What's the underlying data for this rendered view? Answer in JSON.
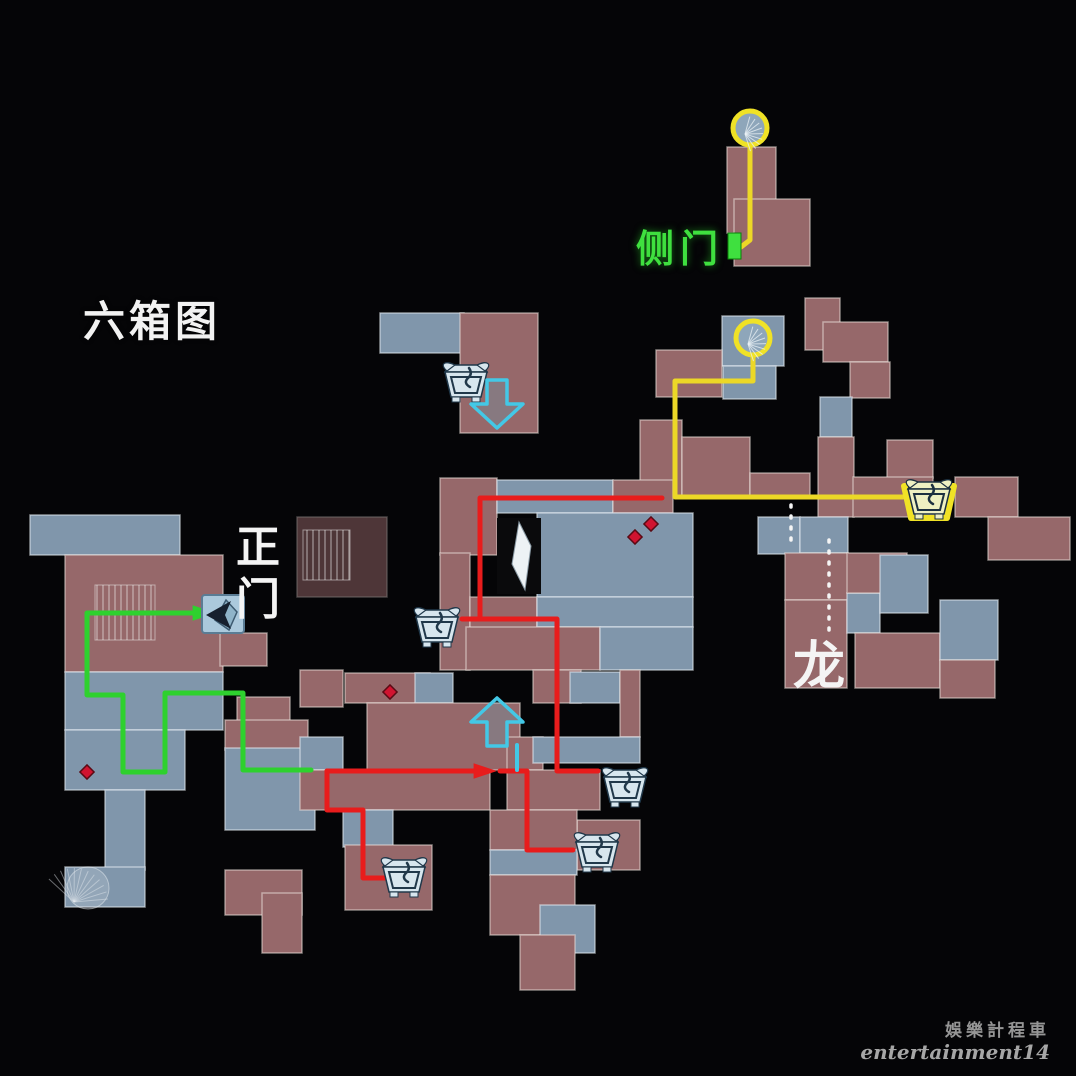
{
  "labels": {
    "title": "六箱图",
    "side_door": "侧门",
    "main_door": "正门",
    "dragon": "龙"
  },
  "watermark": {
    "line1": "娛樂計程車",
    "line2": "entertainment14"
  },
  "colors": {
    "bg": "#050507",
    "red_room": "#96686a",
    "blue_room": "#8096ab",
    "red": "#e81c1c",
    "green": "#2ed12e",
    "yellow": "#ecd827",
    "cyan": "#43c8e6",
    "white": "#f5f5f5",
    "highlight": "#f0e226",
    "label_green": "#3fe03f",
    "diamond": "#d01430"
  },
  "map": {
    "rooms": [
      {
        "x": 727,
        "y": 147,
        "w": 49,
        "h": 86,
        "c": "r"
      },
      {
        "x": 734,
        "y": 199,
        "w": 76,
        "h": 67,
        "c": "r"
      },
      {
        "x": 380,
        "y": 313,
        "w": 84,
        "h": 40,
        "c": "b"
      },
      {
        "x": 460,
        "y": 313,
        "w": 78,
        "h": 120,
        "c": "r"
      },
      {
        "x": 722,
        "y": 316,
        "w": 62,
        "h": 50,
        "c": "b"
      },
      {
        "x": 656,
        "y": 350,
        "w": 66,
        "h": 47,
        "c": "r"
      },
      {
        "x": 723,
        "y": 366,
        "w": 53,
        "h": 33,
        "c": "b"
      },
      {
        "x": 805,
        "y": 298,
        "w": 35,
        "h": 52,
        "c": "r"
      },
      {
        "x": 823,
        "y": 322,
        "w": 65,
        "h": 40,
        "c": "r"
      },
      {
        "x": 850,
        "y": 362,
        "w": 40,
        "h": 36,
        "c": "r"
      },
      {
        "x": 820,
        "y": 397,
        "w": 32,
        "h": 40,
        "c": "b"
      },
      {
        "x": 818,
        "y": 437,
        "w": 36,
        "h": 80,
        "c": "r"
      },
      {
        "x": 887,
        "y": 440,
        "w": 46,
        "h": 38,
        "c": "r"
      },
      {
        "x": 853,
        "y": 477,
        "w": 80,
        "h": 40,
        "c": "r"
      },
      {
        "x": 955,
        "y": 477,
        "w": 63,
        "h": 40,
        "c": "r"
      },
      {
        "x": 988,
        "y": 517,
        "w": 82,
        "h": 43,
        "c": "r"
      },
      {
        "x": 640,
        "y": 420,
        "w": 42,
        "h": 77,
        "c": "r"
      },
      {
        "x": 682,
        "y": 437,
        "w": 68,
        "h": 60,
        "c": "r"
      },
      {
        "x": 750,
        "y": 473,
        "w": 60,
        "h": 24,
        "c": "r"
      },
      {
        "x": 758,
        "y": 517,
        "w": 42,
        "h": 37,
        "c": "b"
      },
      {
        "x": 800,
        "y": 517,
        "w": 48,
        "h": 36,
        "c": "b"
      },
      {
        "x": 785,
        "y": 553,
        "w": 63,
        "h": 47,
        "c": "r"
      },
      {
        "x": 785,
        "y": 600,
        "w": 62,
        "h": 88,
        "c": "r"
      },
      {
        "x": 847,
        "y": 593,
        "w": 33,
        "h": 40,
        "c": "b"
      },
      {
        "x": 847,
        "y": 553,
        "w": 60,
        "h": 40,
        "c": "r"
      },
      {
        "x": 880,
        "y": 555,
        "w": 48,
        "h": 58,
        "c": "b"
      },
      {
        "x": 855,
        "y": 633,
        "w": 85,
        "h": 55,
        "c": "r"
      },
      {
        "x": 940,
        "y": 600,
        "w": 58,
        "h": 60,
        "c": "b"
      },
      {
        "x": 940,
        "y": 660,
        "w": 55,
        "h": 38,
        "c": "r"
      },
      {
        "x": 440,
        "y": 478,
        "w": 57,
        "h": 77,
        "c": "r"
      },
      {
        "x": 497,
        "y": 480,
        "w": 116,
        "h": 33,
        "c": "b"
      },
      {
        "x": 613,
        "y": 480,
        "w": 60,
        "h": 33,
        "c": "r"
      },
      {
        "x": 537,
        "y": 513,
        "w": 156,
        "h": 84,
        "c": "b"
      },
      {
        "x": 440,
        "y": 553,
        "w": 30,
        "h": 117,
        "c": "r"
      },
      {
        "x": 470,
        "y": 597,
        "w": 67,
        "h": 45,
        "c": "r"
      },
      {
        "x": 537,
        "y": 597,
        "w": 156,
        "h": 30,
        "c": "b"
      },
      {
        "x": 466,
        "y": 627,
        "w": 134,
        "h": 43,
        "c": "r"
      },
      {
        "x": 600,
        "y": 627,
        "w": 93,
        "h": 43,
        "c": "b"
      },
      {
        "x": 297,
        "y": 517,
        "w": 90,
        "h": 80,
        "c": "r",
        "d": 1
      },
      {
        "x": 30,
        "y": 515,
        "w": 150,
        "h": 40,
        "c": "b"
      },
      {
        "x": 65,
        "y": 555,
        "w": 158,
        "h": 117,
        "c": "r"
      },
      {
        "x": 220,
        "y": 633,
        "w": 47,
        "h": 33,
        "c": "r"
      },
      {
        "x": 65,
        "y": 672,
        "w": 158,
        "h": 58,
        "c": "b"
      },
      {
        "x": 237,
        "y": 697,
        "w": 53,
        "h": 33,
        "c": "r"
      },
      {
        "x": 225,
        "y": 720,
        "w": 83,
        "h": 30,
        "c": "r"
      },
      {
        "x": 225,
        "y": 748,
        "w": 90,
        "h": 82,
        "c": "b"
      },
      {
        "x": 65,
        "y": 730,
        "w": 120,
        "h": 60,
        "c": "b"
      },
      {
        "x": 105,
        "y": 790,
        "w": 40,
        "h": 80,
        "c": "b"
      },
      {
        "x": 65,
        "y": 867,
        "w": 80,
        "h": 40,
        "c": "b"
      },
      {
        "x": 225,
        "y": 870,
        "w": 77,
        "h": 45,
        "c": "r"
      },
      {
        "x": 262,
        "y": 893,
        "w": 40,
        "h": 60,
        "c": "r"
      },
      {
        "x": 300,
        "y": 670,
        "w": 43,
        "h": 37,
        "c": "r"
      },
      {
        "x": 345,
        "y": 673,
        "w": 85,
        "h": 30,
        "c": "r"
      },
      {
        "x": 415,
        "y": 673,
        "w": 38,
        "h": 30,
        "c": "b"
      },
      {
        "x": 367,
        "y": 703,
        "w": 153,
        "h": 67,
        "c": "r"
      },
      {
        "x": 533,
        "y": 670,
        "w": 48,
        "h": 33,
        "c": "r"
      },
      {
        "x": 570,
        "y": 672,
        "w": 50,
        "h": 31,
        "c": "b"
      },
      {
        "x": 620,
        "y": 670,
        "w": 20,
        "h": 67,
        "c": "r"
      },
      {
        "x": 507,
        "y": 737,
        "w": 36,
        "h": 33,
        "c": "r"
      },
      {
        "x": 533,
        "y": 737,
        "w": 107,
        "h": 26,
        "c": "b"
      },
      {
        "x": 300,
        "y": 737,
        "w": 43,
        "h": 33,
        "c": "b"
      },
      {
        "x": 300,
        "y": 770,
        "w": 190,
        "h": 40,
        "c": "r"
      },
      {
        "x": 507,
        "y": 770,
        "w": 93,
        "h": 40,
        "c": "r"
      },
      {
        "x": 343,
        "y": 810,
        "w": 50,
        "h": 37,
        "c": "b"
      },
      {
        "x": 345,
        "y": 845,
        "w": 87,
        "h": 65,
        "c": "r"
      },
      {
        "x": 577,
        "y": 820,
        "w": 63,
        "h": 50,
        "c": "r"
      },
      {
        "x": 490,
        "y": 810,
        "w": 87,
        "h": 40,
        "c": "r"
      },
      {
        "x": 490,
        "y": 850,
        "w": 87,
        "h": 25,
        "c": "b"
      },
      {
        "x": 490,
        "y": 875,
        "w": 85,
        "h": 60,
        "c": "r"
      },
      {
        "x": 540,
        "y": 905,
        "w": 55,
        "h": 48,
        "c": "b"
      },
      {
        "x": 520,
        "y": 935,
        "w": 55,
        "h": 55,
        "c": "r"
      }
    ],
    "hatches": [
      {
        "x": 95,
        "y": 585,
        "w": 60,
        "h": 55
      },
      {
        "x": 303,
        "y": 530,
        "w": 47,
        "h": 50
      }
    ],
    "routes": [
      {
        "name": "yellow-top",
        "color": "yellow",
        "pts": [
          [
            750,
            146
          ],
          [
            750,
            240
          ],
          [
            741,
            247
          ]
        ]
      },
      {
        "name": "yellow-main",
        "color": "yellow",
        "pts": [
          [
            753,
            357
          ],
          [
            753,
            381
          ],
          [
            675,
            381
          ],
          [
            675,
            497
          ],
          [
            903,
            497
          ]
        ]
      },
      {
        "name": "green-main",
        "color": "green",
        "arrow_end": true,
        "pts": [
          [
            311,
            770
          ],
          [
            243,
            770
          ],
          [
            243,
            693
          ],
          [
            165,
            693
          ],
          [
            165,
            772
          ],
          [
            123,
            772
          ],
          [
            123,
            695
          ],
          [
            87,
            695
          ],
          [
            87,
            613
          ],
          [
            203,
            613
          ]
        ]
      },
      {
        "name": "red-upper",
        "color": "red",
        "pts": [
          [
            662,
            498
          ],
          [
            480,
            498
          ],
          [
            480,
            617
          ]
        ]
      },
      {
        "name": "red-right",
        "color": "red",
        "pts": [
          [
            462,
            619
          ],
          [
            557,
            619
          ],
          [
            557,
            771
          ],
          [
            598,
            771
          ]
        ]
      },
      {
        "name": "red-main",
        "color": "red",
        "arrow_end": true,
        "pts": [
          [
            327,
            771
          ],
          [
            484,
            771
          ]
        ]
      },
      {
        "name": "red-branch-a",
        "color": "red",
        "pts": [
          [
            327,
            771
          ],
          [
            327,
            810
          ],
          [
            363,
            810
          ],
          [
            363,
            878
          ],
          [
            386,
            878
          ]
        ]
      },
      {
        "name": "red-branch-b",
        "color": "red",
        "pts": [
          [
            500,
            771
          ],
          [
            527,
            771
          ],
          [
            527,
            850
          ],
          [
            573,
            850
          ]
        ]
      },
      {
        "name": "cyan-connector",
        "color": "cyan",
        "width": 4,
        "pts": [
          [
            517,
            745
          ],
          [
            517,
            770
          ]
        ]
      },
      {
        "name": "dragon-dotted-a",
        "color": "white",
        "dashed": true,
        "pts": [
          [
            791,
            505
          ],
          [
            791,
            542
          ]
        ]
      },
      {
        "name": "dragon-dotted-b",
        "color": "white",
        "dashed": true,
        "pts": [
          [
            829,
            540
          ],
          [
            829,
            630
          ]
        ]
      }
    ],
    "markers": {
      "stair_circles": [
        {
          "x": 750,
          "y": 128
        },
        {
          "x": 753,
          "y": 338
        }
      ],
      "item_boxes": [
        {
          "x": 466,
          "y": 381
        },
        {
          "x": 437,
          "y": 626
        },
        {
          "x": 929,
          "y": 498,
          "highlight": true
        },
        {
          "x": 625,
          "y": 786
        },
        {
          "x": 597,
          "y": 851
        },
        {
          "x": 404,
          "y": 876
        }
      ],
      "arrows": [
        {
          "x": 497,
          "y": 404,
          "dir": "down"
        },
        {
          "x": 497,
          "y": 722,
          "dir": "up"
        }
      ],
      "main_door": {
        "x": 223,
        "y": 614
      },
      "side_door": {
        "x": 728,
        "y": 233,
        "w": 13,
        "h": 26
      },
      "player": {
        "x": 519,
        "y": 556
      },
      "diamonds": [
        {
          "x": 87,
          "y": 772
        },
        {
          "x": 390,
          "y": 692
        },
        {
          "x": 635,
          "y": 537
        },
        {
          "x": 651,
          "y": 524
        }
      ],
      "spiral_fan": {
        "x": 88,
        "y": 888
      }
    }
  }
}
